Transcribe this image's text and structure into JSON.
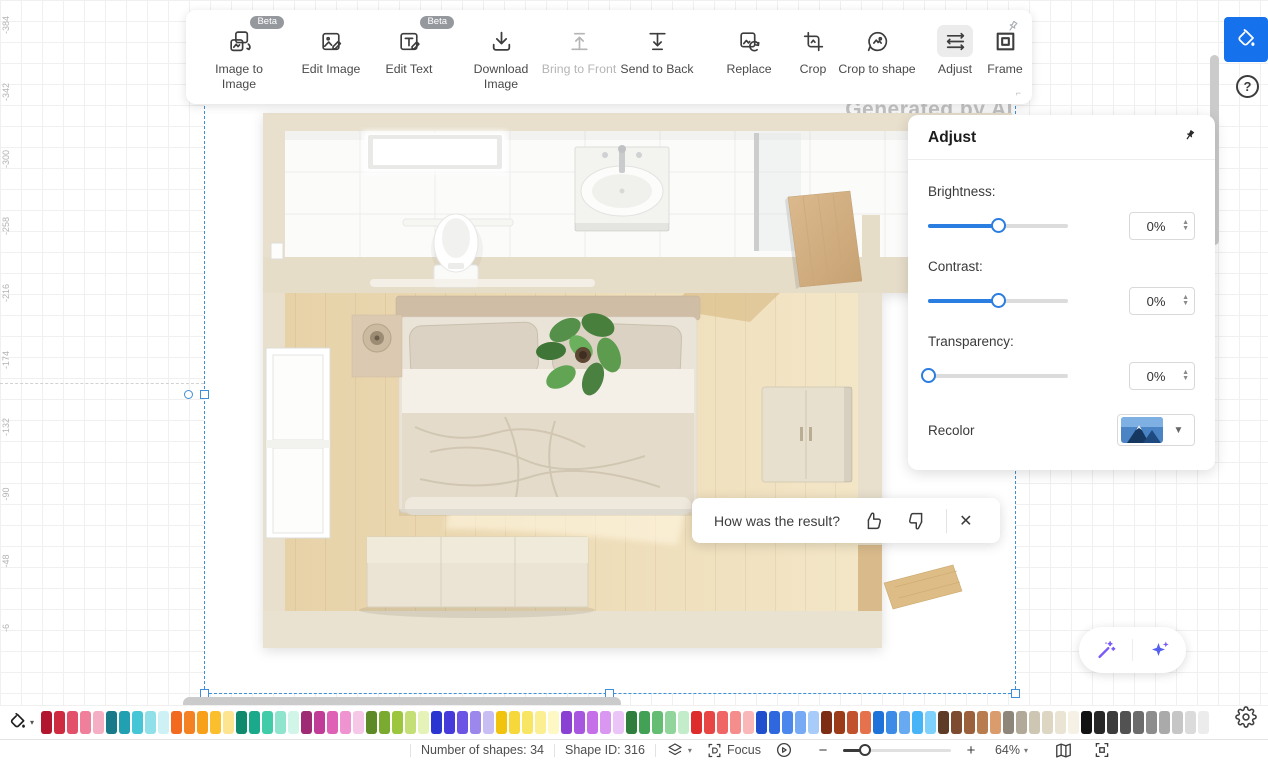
{
  "toolbar": {
    "beta_label": "Beta",
    "buttons": [
      {
        "label": "Image to Image",
        "beta": true
      },
      {
        "label": "Edit Image"
      },
      {
        "label": "Edit Text",
        "beta": true
      },
      {
        "label": "Download Image"
      },
      {
        "label": "Bring to Front",
        "disabled": true
      },
      {
        "label": "Send to Back"
      },
      {
        "label": "Replace"
      },
      {
        "label": "Crop"
      },
      {
        "label": "Crop to shape"
      },
      {
        "label": "Adjust",
        "active": true
      },
      {
        "label": "Frame"
      }
    ]
  },
  "adjust_panel": {
    "title": "Adjust",
    "sliders": [
      {
        "label": "Brightness:",
        "value": "0%",
        "percent": 50
      },
      {
        "label": "Contrast:",
        "value": "0%",
        "percent": 50
      },
      {
        "label": "Transparency:",
        "value": "0%",
        "percent": 0
      }
    ],
    "recolor_label": "Recolor"
  },
  "canvas": {
    "watermark": "Generated by AI"
  },
  "feedback_toast": {
    "question": "How was the result?"
  },
  "status_bar": {
    "shapes": "Number of shapes: 34",
    "shape_id": "Shape ID: 316",
    "focus": "Focus",
    "zoom": "64%",
    "zoom_percent": 20
  },
  "ruler": {
    "labels": [
      "-384",
      "-342",
      "-300",
      "-258",
      "-216",
      "-174",
      "-132",
      "-90",
      "-48",
      "-6"
    ]
  },
  "palette": {
    "colors": [
      "#B2152E",
      "#CE2A40",
      "#E25069",
      "#EF7F9B",
      "#F5AFC4",
      "#187A89",
      "#20A0B0",
      "#45C6D6",
      "#8FE0E9",
      "#CDF1F5",
      "#F26A1F",
      "#F58222",
      "#F9A01B",
      "#FBBF2D",
      "#FCE490",
      "#0F8A6C",
      "#1AA98A",
      "#41CCA9",
      "#8FE4CE",
      "#D2F5EA",
      "#9E2B74",
      "#C13C96",
      "#DF61B5",
      "#EF94D1",
      "#F7C7E7",
      "#5D8A26",
      "#7BAA31",
      "#9CC63E",
      "#C4DF76",
      "#E6F3B8",
      "#2B35CF",
      "#463ADB",
      "#6C54E4",
      "#9C87ED",
      "#C8BEF4",
      "#F2C30E",
      "#F6D83A",
      "#F9E564",
      "#FBEF92",
      "#FDF8C4",
      "#8A40D2",
      "#A757DF",
      "#C570E9",
      "#DA97F1",
      "#ECC5F8",
      "#2F7E3D",
      "#42A154",
      "#65BD74",
      "#91D59C",
      "#C3ECCA",
      "#DE2C2C",
      "#E84545",
      "#F06565",
      "#F58D8D",
      "#F9B7B7",
      "#1F4FCC",
      "#2F67DF",
      "#4B87ED",
      "#77AAF4",
      "#A8CCFA",
      "#7C2D13",
      "#9C3B17",
      "#C2522D",
      "#E5724C",
      "#1D73D9",
      "#3C8CE7",
      "#67AAF1",
      "#48B4F8",
      "#7ED1FC",
      "#5E3B27",
      "#7D4B2F",
      "#9A613C",
      "#B97C4E",
      "#DA9B6D",
      "#8E8779",
      "#B1AA98",
      "#CDC6B3",
      "#DDD6C3",
      "#EAE4D4",
      "#F5F1E5",
      "#121212",
      "#272727",
      "#3C3C3C",
      "#525252",
      "#6C6C6C",
      "#8D8D8D",
      "#AAAAAA",
      "#C6C6C6",
      "#DBDBDB",
      "#ECECEC"
    ]
  },
  "theme": {
    "accent_blue": "#1672EC",
    "slider_blue": "#2A7DE1",
    "selection_blue": "#3F8FD8"
  }
}
